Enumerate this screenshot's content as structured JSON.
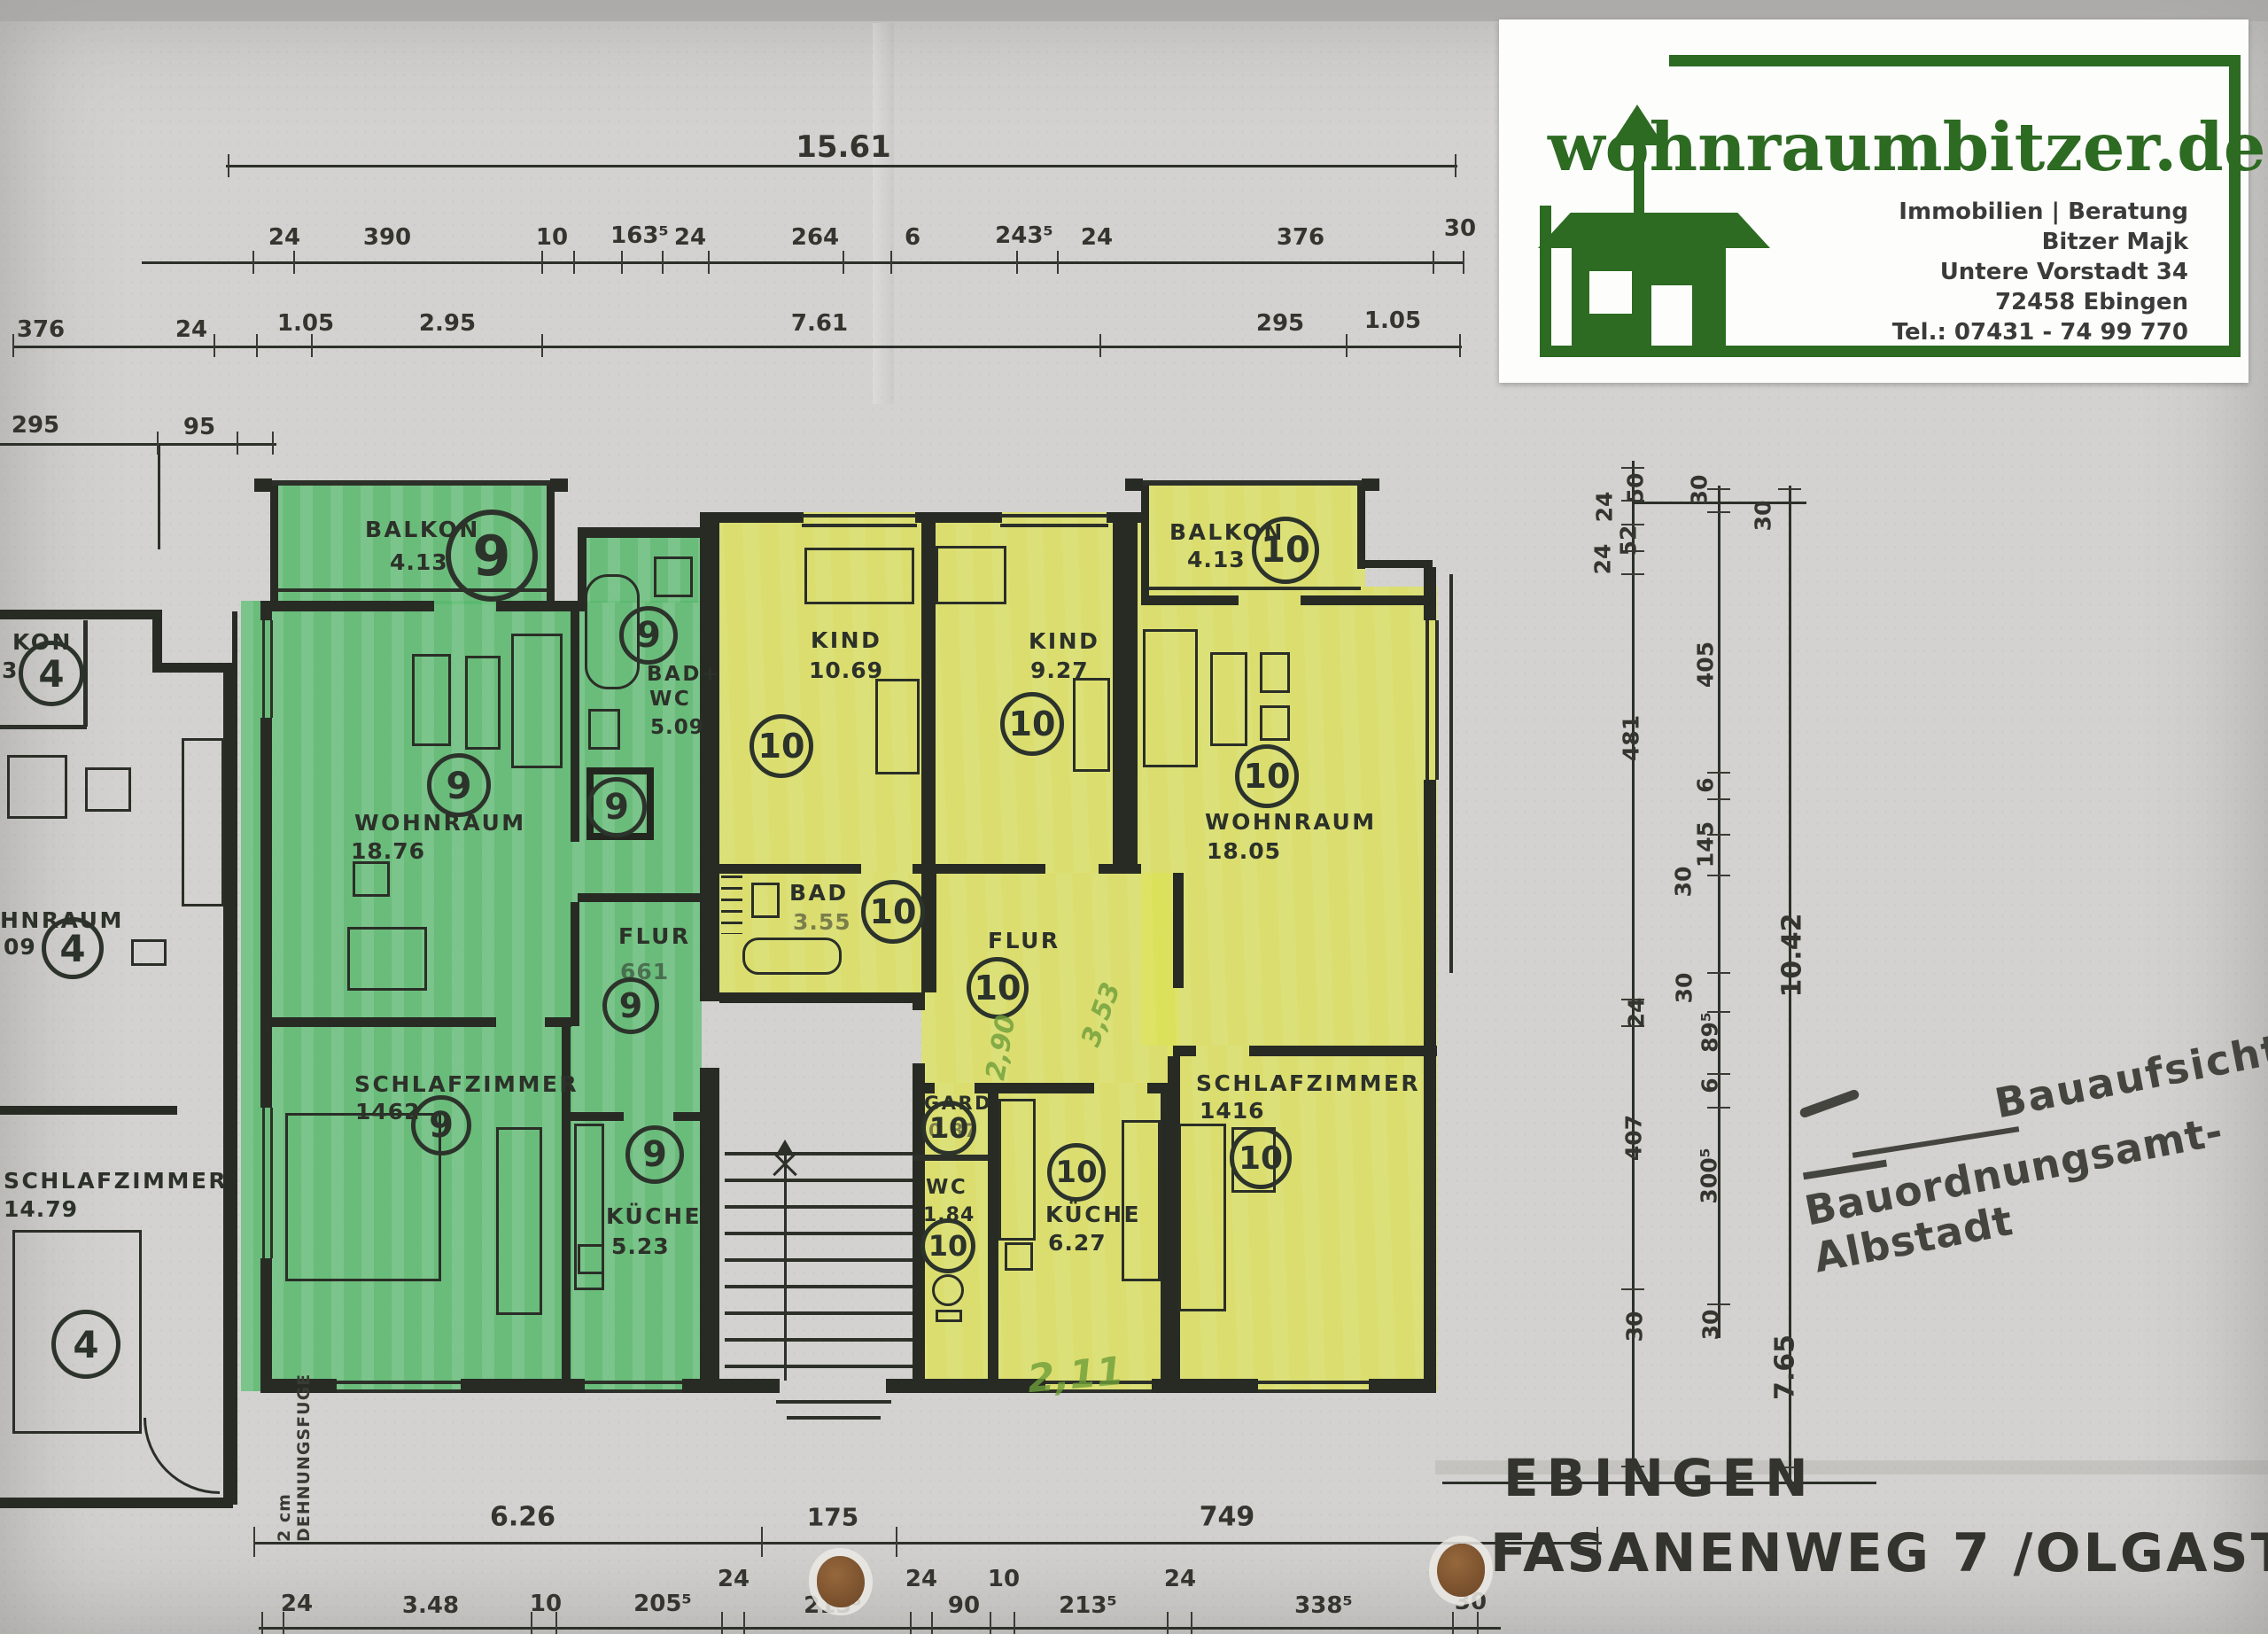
{
  "page": {
    "paper": "#d3d2d0",
    "ink": "#2c3029",
    "highlight_green": "#58b96d",
    "highlight_yellow": "#dde257"
  },
  "logo": {
    "title": "wohnraumbitzer.de",
    "tagline": "Immobilien | Beratung",
    "name": "Bitzer Majk",
    "street": "Untere Vorstadt 34",
    "city": "72458 Ebingen",
    "phone": "Tel.: 07431 - 74 99 770",
    "brand_color": "#2d6a22"
  },
  "stamp": {
    "line1": "Bauaufsicht",
    "line2": "Bauordnungsamt-Albstadt"
  },
  "title_block": {
    "city": "EBINGEN",
    "street": "FASANENWEG 7 /OLGASTR 1"
  },
  "units": {
    "u4": "4",
    "u9": "9",
    "u10": "10"
  },
  "rooms": [
    {
      "label": "BALKON",
      "area": "4.13"
    },
    {
      "label": "WOHNRAUM",
      "area": "18.76"
    },
    {
      "label": "BAD+",
      "line2": "WC",
      "area": "5.09"
    },
    {
      "label": "FLUR",
      "area": "661"
    },
    {
      "label": "KÜCHE",
      "area": "5.23"
    },
    {
      "label": "SCHLAFZIMMER",
      "area": "1462"
    },
    {
      "label": "KIND",
      "area": "10.69"
    },
    {
      "label": "KIND",
      "area": "9.27"
    },
    {
      "label": "BALKON",
      "area": "4.13"
    },
    {
      "label": "WOHNRAUM",
      "area": "18.05"
    },
    {
      "label": "BAD",
      "area": "3.55"
    },
    {
      "label": "FLUR"
    },
    {
      "label": "GARD",
      "area": "0.87"
    },
    {
      "label": "WC",
      "area": "1.84"
    },
    {
      "label": "KÜCHE",
      "area": "6.27"
    },
    {
      "label": "SCHLAFZIMMER",
      "area": "1416"
    },
    {
      "label": "KON",
      "area": "3"
    },
    {
      "label": "HNRAUM",
      "area": "09"
    },
    {
      "label": "SCHLAFZIMMER",
      "area": "14.79"
    }
  ],
  "dims": {
    "total_top": "15.61",
    "row2": [
      "24",
      "390",
      "10",
      "163⁵",
      "24",
      "264",
      "6",
      "243⁵",
      "24",
      "376",
      "30"
    ],
    "row3": [
      "376",
      "24",
      "1.05",
      "2.95",
      "7.61",
      "295",
      "1.05"
    ],
    "left_line": [
      "295",
      "95"
    ],
    "right_a": [
      "50",
      "24",
      "52",
      "24",
      "481",
      "24",
      "407",
      "30"
    ],
    "right_b": [
      "30",
      "405",
      "6",
      "145",
      "30",
      "30",
      "89⁵",
      "6",
      "300⁵",
      "30"
    ],
    "right_c": [
      "30",
      "10.42",
      "7.65"
    ],
    "bottom_a": [
      "6.26",
      "175",
      "749"
    ],
    "bottom_b": [
      "24",
      "3.48",
      "10",
      "205⁵",
      "24",
      "213⁵",
      "24",
      "90",
      "10",
      "213⁵",
      "24",
      "338⁵",
      "30"
    ]
  },
  "annotations": {
    "joint_line1": "2 cm",
    "joint_line2": "DEHNUNGSFUGE",
    "hand1": "2,90",
    "hand2": "3,53",
    "hand3": "2,11",
    "pencil_color": "#6f9e3a"
  }
}
